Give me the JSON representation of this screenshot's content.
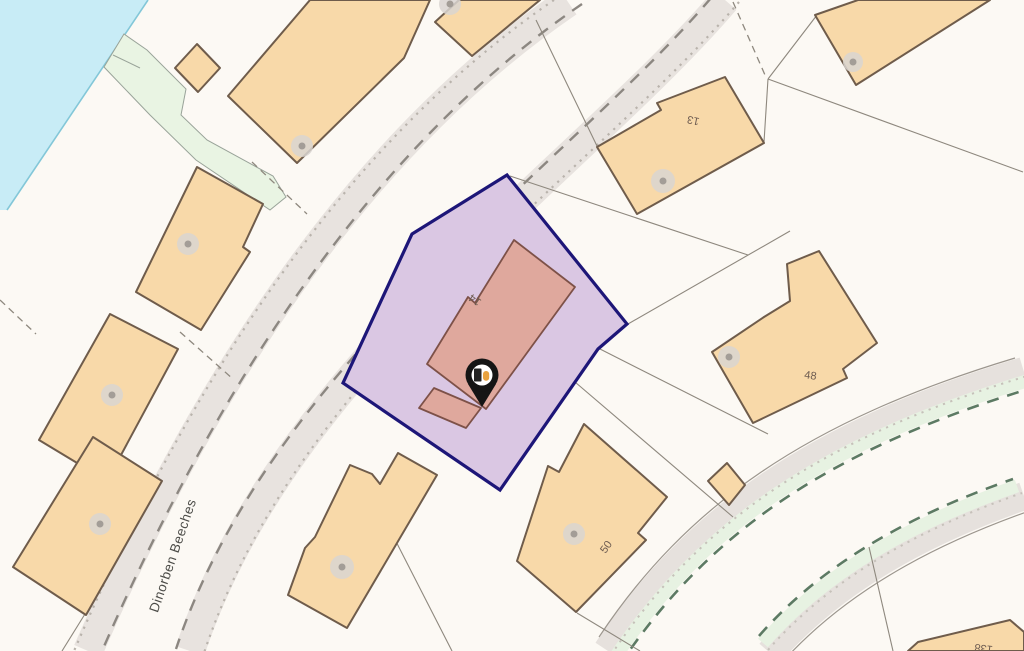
{
  "map": {
    "street_label": "Dinorben Beeches",
    "plot": {
      "house_number": "14",
      "fill_color": "#dac7e3",
      "boundary_color": "#1d1678",
      "building_fill": "#dfa89d"
    },
    "house_numbers": {
      "n13": "13",
      "n48": "48",
      "n50": "50",
      "n138": "138"
    },
    "marker": {
      "name": "property-location-pin",
      "pin_color": "#151515",
      "glyph_colors": [
        "#242424",
        "#e8a23f"
      ]
    },
    "theme_colors": {
      "land": "#fcf9f4",
      "building": "#f8d9a9",
      "building_outline": "#6f5c4b",
      "water": "#c8ecf6",
      "greenway": "#e9f4e3",
      "road": "#e8e3df"
    }
  }
}
